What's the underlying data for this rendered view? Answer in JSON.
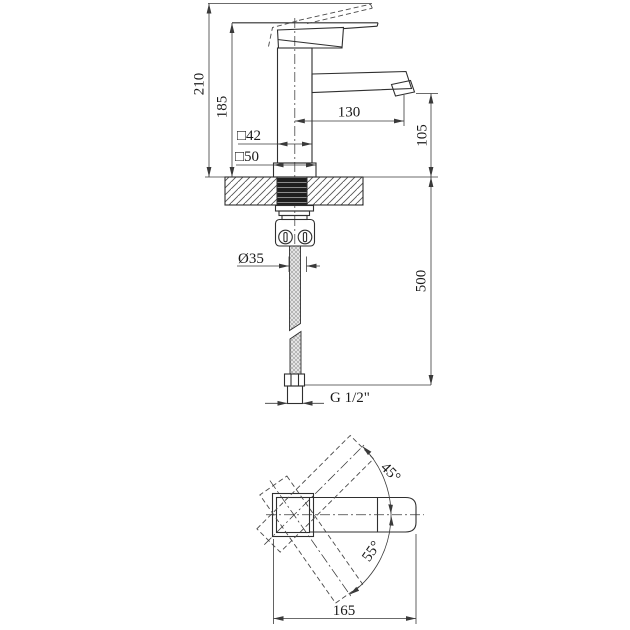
{
  "colors": {
    "background": "#ffffff",
    "line": "#2f2f2f",
    "dimension_line": "#3a3a3a",
    "text": "#1a1a1a",
    "thread_fill": "#1f1f1f"
  },
  "side_view": {
    "labels": {
      "total_height": "210",
      "lever_height": "185",
      "spout_reach": "130",
      "spout_height": "105",
      "body_square": "□42",
      "base_square": "□50",
      "hole_diameter": "Ø35",
      "hose_length": "500",
      "thread": "G 1/2\""
    }
  },
  "top_view": {
    "labels": {
      "overall_length": "165",
      "handle_swing_up": "45°",
      "handle_swing_down": "55°"
    }
  }
}
